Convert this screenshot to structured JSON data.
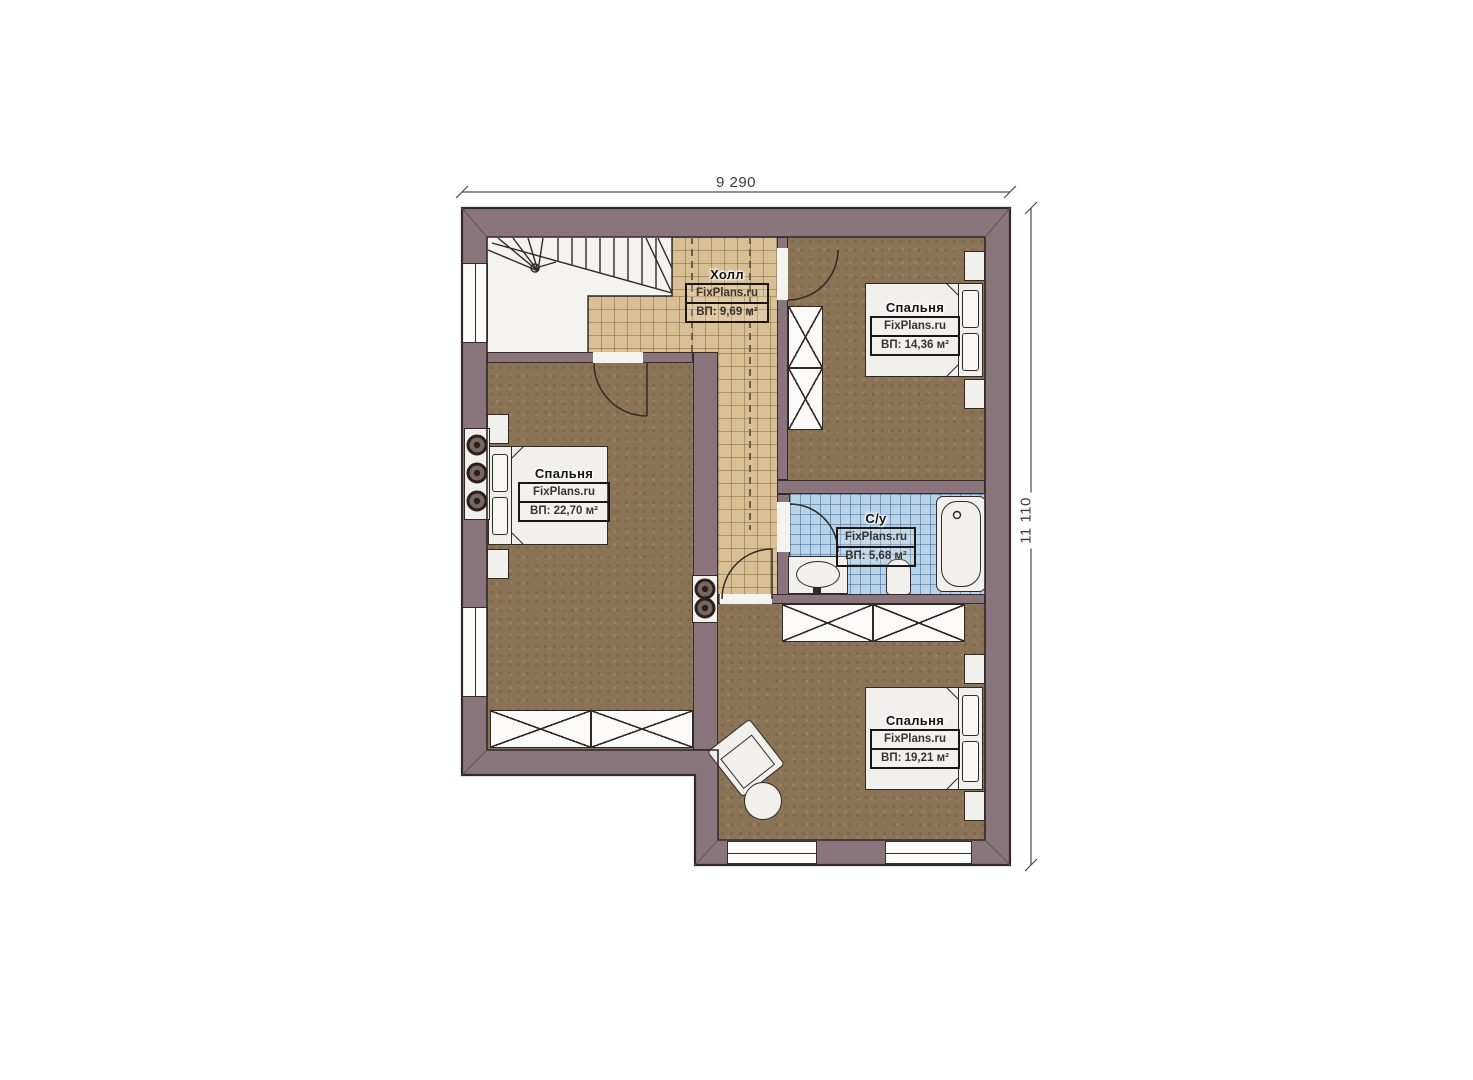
{
  "dimensions": {
    "top": "9 290",
    "right": "11 110"
  },
  "rooms": [
    {
      "key": "hall",
      "name": "Холл",
      "brand": "FixPlans.ru",
      "area": "ВП: 9,69 м²"
    },
    {
      "key": "bedroom-top-right",
      "name": "Спальня",
      "brand": "FixPlans.ru",
      "area": "ВП: 14,36 м²"
    },
    {
      "key": "bedroom-left",
      "name": "Спальня",
      "brand": "FixPlans.ru",
      "area": "ВП: 22,70 м²"
    },
    {
      "key": "bathroom",
      "name": "С/у",
      "brand": "FixPlans.ru",
      "area": "ВП: 5,68 м²"
    },
    {
      "key": "bedroom-bottom",
      "name": "Спальня",
      "brand": "FixPlans.ru",
      "area": "ВП: 19,21 м²"
    }
  ],
  "colors": {
    "wall": "#8b757c",
    "outline": "#2f2a28",
    "room_floor": "#8b7355",
    "hall_floor": "#d9c094",
    "bath_floor": "#b8d2e8",
    "furniture": "#f1f0ed"
  }
}
